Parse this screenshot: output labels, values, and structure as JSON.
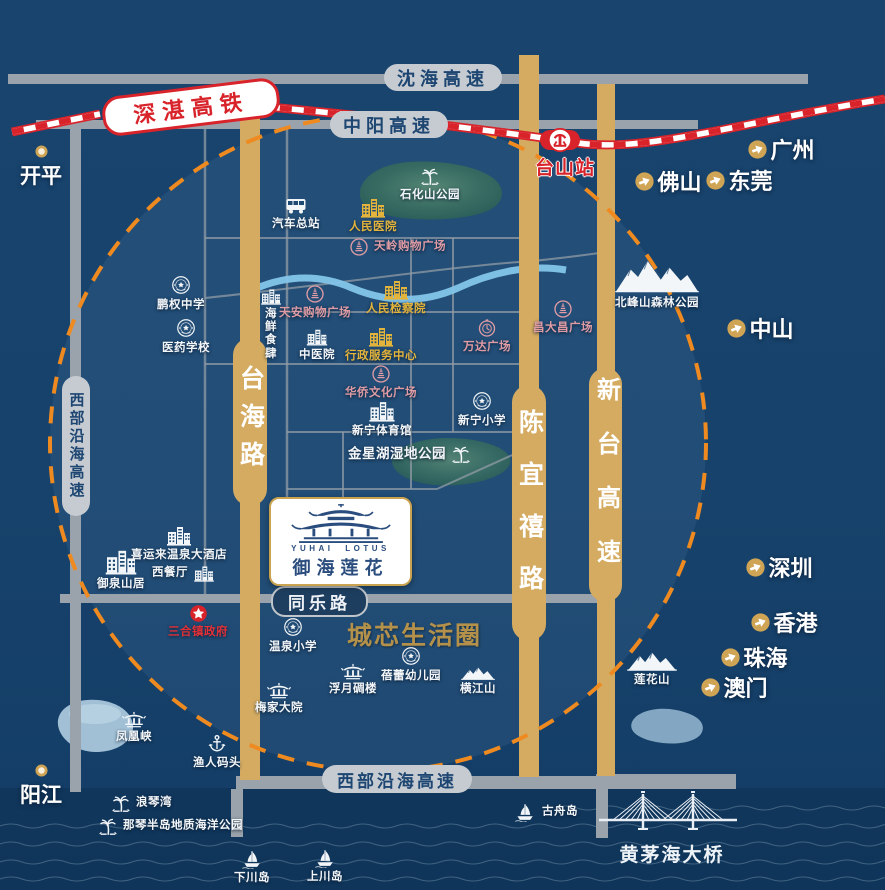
{
  "map": {
    "rail": {
      "line_label": "深湛高铁",
      "station_label": "台山站"
    },
    "highways": {
      "shenhai": "沈海高速",
      "zhongyang": "中阳高速",
      "west_coastal_left": "西部沿海高速",
      "west_coastal_bottom": "西部沿海高速",
      "tongle": "同乐路",
      "taihai": "台海路",
      "chenyixi": "陈宜禧路",
      "xintai": "新台高速"
    },
    "logo": {
      "en": "YUHAI LOTUS",
      "cn": "御海莲花"
    },
    "slogan": "城芯生活圈",
    "bridge_label": "黄茅海大桥",
    "cities": [
      {
        "label": "开平",
        "x": 41,
        "y": 151,
        "type": "ring"
      },
      {
        "label": "广州",
        "x": 757,
        "y": 149,
        "type": "arrow"
      },
      {
        "label": "佛山",
        "x": 644,
        "y": 181,
        "type": "arrow"
      },
      {
        "label": "东莞",
        "x": 715,
        "y": 180,
        "type": "arrow"
      },
      {
        "label": "中山",
        "x": 736,
        "y": 328,
        "type": "arrow"
      },
      {
        "label": "深圳",
        "x": 755,
        "y": 567,
        "type": "arrow"
      },
      {
        "label": "香港",
        "x": 760,
        "y": 622,
        "type": "arrow"
      },
      {
        "label": "珠海",
        "x": 730,
        "y": 657,
        "type": "arrow"
      },
      {
        "label": "澳门",
        "x": 710,
        "y": 687,
        "type": "arrow"
      },
      {
        "label": "阳江",
        "x": 41,
        "y": 770,
        "type": "ring"
      }
    ],
    "pois": [
      {
        "label": "石化山公园",
        "x": 430,
        "y": 176,
        "icon": "palm"
      },
      {
        "label": "汽车总站",
        "x": 296,
        "y": 205,
        "icon": "bus"
      },
      {
        "label": "人民医院",
        "x": 373,
        "y": 207,
        "icon": "building",
        "color": "yellow"
      },
      {
        "label": "天岭购物广场",
        "x": 359,
        "y": 247,
        "icon": "mall",
        "color": "pink",
        "lp": "r"
      },
      {
        "label": "鹏权中学",
        "x": 181,
        "y": 285,
        "icon": "seal"
      },
      {
        "label": "医药学校",
        "x": 186,
        "y": 328,
        "icon": "seal"
      },
      {
        "label": "海鲜\n食肆",
        "x": 271,
        "y": 296,
        "icon": "building",
        "lp": "b2",
        "sz": [
          22,
          18
        ]
      },
      {
        "label": "天安购物广场",
        "x": 315,
        "y": 294,
        "icon": "mall",
        "color": "pink"
      },
      {
        "label": "人民检察院",
        "x": 396,
        "y": 289,
        "icon": "building",
        "color": "yellow"
      },
      {
        "label": "中医院",
        "x": 317,
        "y": 336,
        "icon": "building",
        "sz": [
          22,
          19
        ]
      },
      {
        "label": "行政服务中心",
        "x": 381,
        "y": 336,
        "icon": "building",
        "color": "yellow"
      },
      {
        "label": "华侨文化广场",
        "x": 381,
        "y": 374,
        "icon": "mall",
        "color": "pink"
      },
      {
        "label": "万达广场",
        "x": 487,
        "y": 328,
        "icon": "clock",
        "color": "pink"
      },
      {
        "label": "昌大昌广场",
        "x": 563,
        "y": 309,
        "icon": "mall",
        "color": "pink"
      },
      {
        "label": "北峰山森林公园",
        "x": 657,
        "y": 276,
        "icon": "mountain-lg",
        "sz": [
          88,
          36
        ]
      },
      {
        "label": "新宁小学",
        "x": 482,
        "y": 401,
        "icon": "seal"
      },
      {
        "label": "新宁体育馆",
        "x": 382,
        "y": 410,
        "icon": "building",
        "sz": [
          28,
          23
        ]
      },
      {
        "label": "金星湖湿地公园",
        "x": 461,
        "y": 454,
        "icon": "palm",
        "lp": "l",
        "fs": 13.5
      },
      {
        "label": "喜运来温泉大酒店",
        "x": 179,
        "y": 535,
        "icon": "building"
      },
      {
        "label": "西餐厅",
        "x": 204,
        "y": 573,
        "icon": "building",
        "lp": "l",
        "sz": [
          22,
          18
        ]
      },
      {
        "label": "御泉山居",
        "x": 121,
        "y": 561,
        "icon": "building",
        "sz": [
          34,
          28
        ]
      },
      {
        "label": "三合镇政府",
        "x": 198,
        "y": 613,
        "icon": "star",
        "color": "red"
      },
      {
        "label": "温泉小学",
        "x": 293,
        "y": 627,
        "icon": "seal"
      },
      {
        "label": "蓓蕾幼儿园",
        "x": 411,
        "y": 656,
        "icon": "seal"
      },
      {
        "label": "浮月碉楼",
        "x": 353,
        "y": 671,
        "icon": "pagoda"
      },
      {
        "label": "梅家大院",
        "x": 279,
        "y": 690,
        "icon": "pagoda"
      },
      {
        "label": "横江山",
        "x": 478,
        "y": 672,
        "icon": "mountain",
        "sz": [
          34,
          15
        ]
      },
      {
        "label": "莲花山",
        "x": 652,
        "y": 660,
        "icon": "mountain",
        "sz": [
          52,
          22
        ]
      },
      {
        "label": "凤凰峡",
        "x": 134,
        "y": 719,
        "icon": "pagoda"
      },
      {
        "label": "渔人码头",
        "x": 217,
        "y": 744,
        "icon": "anchor"
      },
      {
        "label": "浪琴湾",
        "x": 121,
        "y": 803,
        "icon": "palm",
        "lp": "r"
      },
      {
        "label": "那琴半岛地质海洋公园",
        "x": 108,
        "y": 826,
        "icon": "palm",
        "lp": "r"
      },
      {
        "label": "古舟岛",
        "x": 525,
        "y": 812,
        "icon": "sailboat",
        "lp": "r"
      },
      {
        "label": "下川岛",
        "x": 252,
        "y": 859,
        "icon": "sailboat"
      },
      {
        "label": "上川岛",
        "x": 325,
        "y": 858,
        "icon": "sailboat"
      }
    ],
    "palette": {
      "background": "#17426b",
      "gold_road": "#d4ab61",
      "gray_road": "#9aa3ab",
      "orange_dash": "#ee8a1f",
      "pink": "#df9ca5",
      "yellow": "#e3b43c",
      "red": "#d8232b",
      "river_blue": "#84c5ea",
      "slogan_gold": "#b3914b"
    }
  }
}
